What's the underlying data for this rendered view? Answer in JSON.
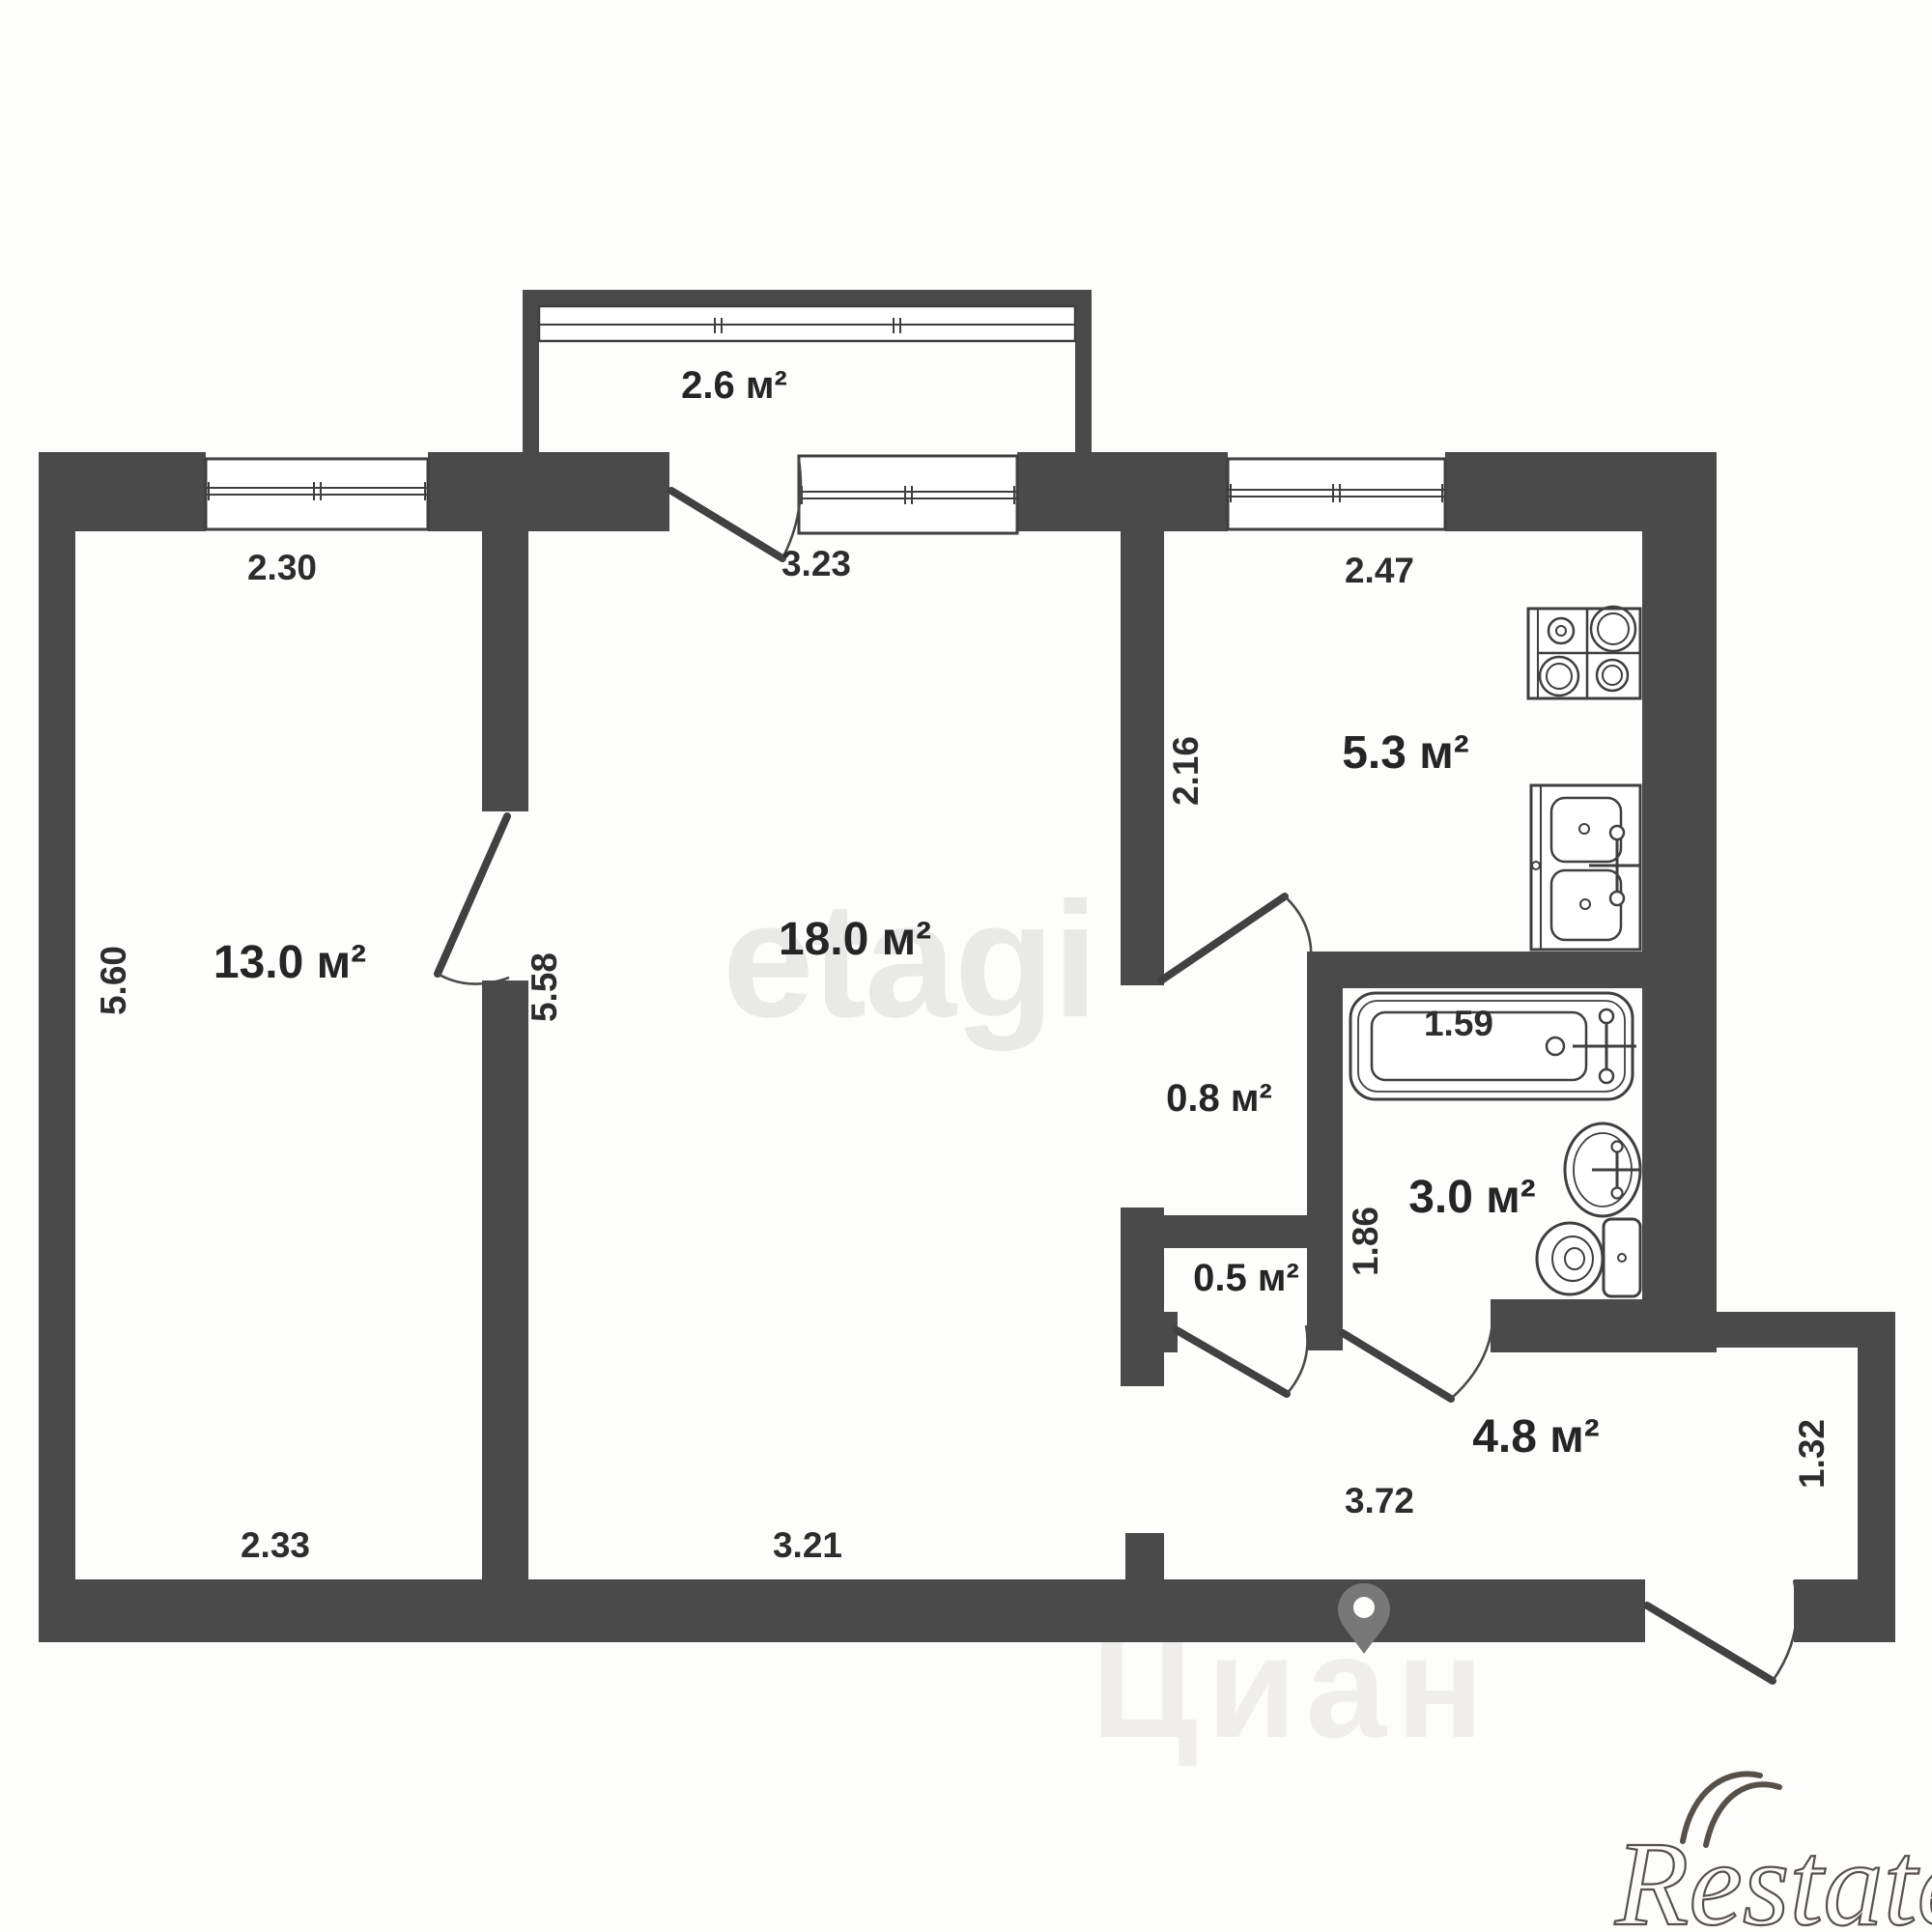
{
  "title": "Apartment floor plan",
  "rooms": {
    "balcony": "2.6 м²",
    "bedroom": "13.0 м²",
    "living_room": "18.0 м²",
    "kitchen": "5.3 м²",
    "inner_hallway": "0.8 м²",
    "bathroom": "3.0 м²",
    "closet": "0.5 м²",
    "entrance_hall": "4.8 м²"
  },
  "dimensions": {
    "bedroom_width_top": "2.30",
    "bedroom_height_left": "5.60",
    "bedroom_width_bottom": "2.33",
    "living_width_top": "3.23",
    "living_height_left": "5.58",
    "living_width_bottom": "3.21",
    "kitchen_width_top": "2.47",
    "kitchen_height_left": "2.16",
    "bathtub_length": "1.59",
    "bathroom_height_left": "1.86",
    "hall_width_bottom": "3.72",
    "hall_height_right": "1.32"
  },
  "watermarks": {
    "center_logo": "etagi",
    "bottom_right_logo": "Restate",
    "map_pin_logo": "Циан"
  },
  "colors": {
    "wall": "#4a4a4a",
    "fixture_line": "#3f3f3f",
    "text": "#2d2d2d",
    "background": "#fdfdfc",
    "watermark_light": "#e9e9e7",
    "watermark_logo": "#57514c"
  }
}
